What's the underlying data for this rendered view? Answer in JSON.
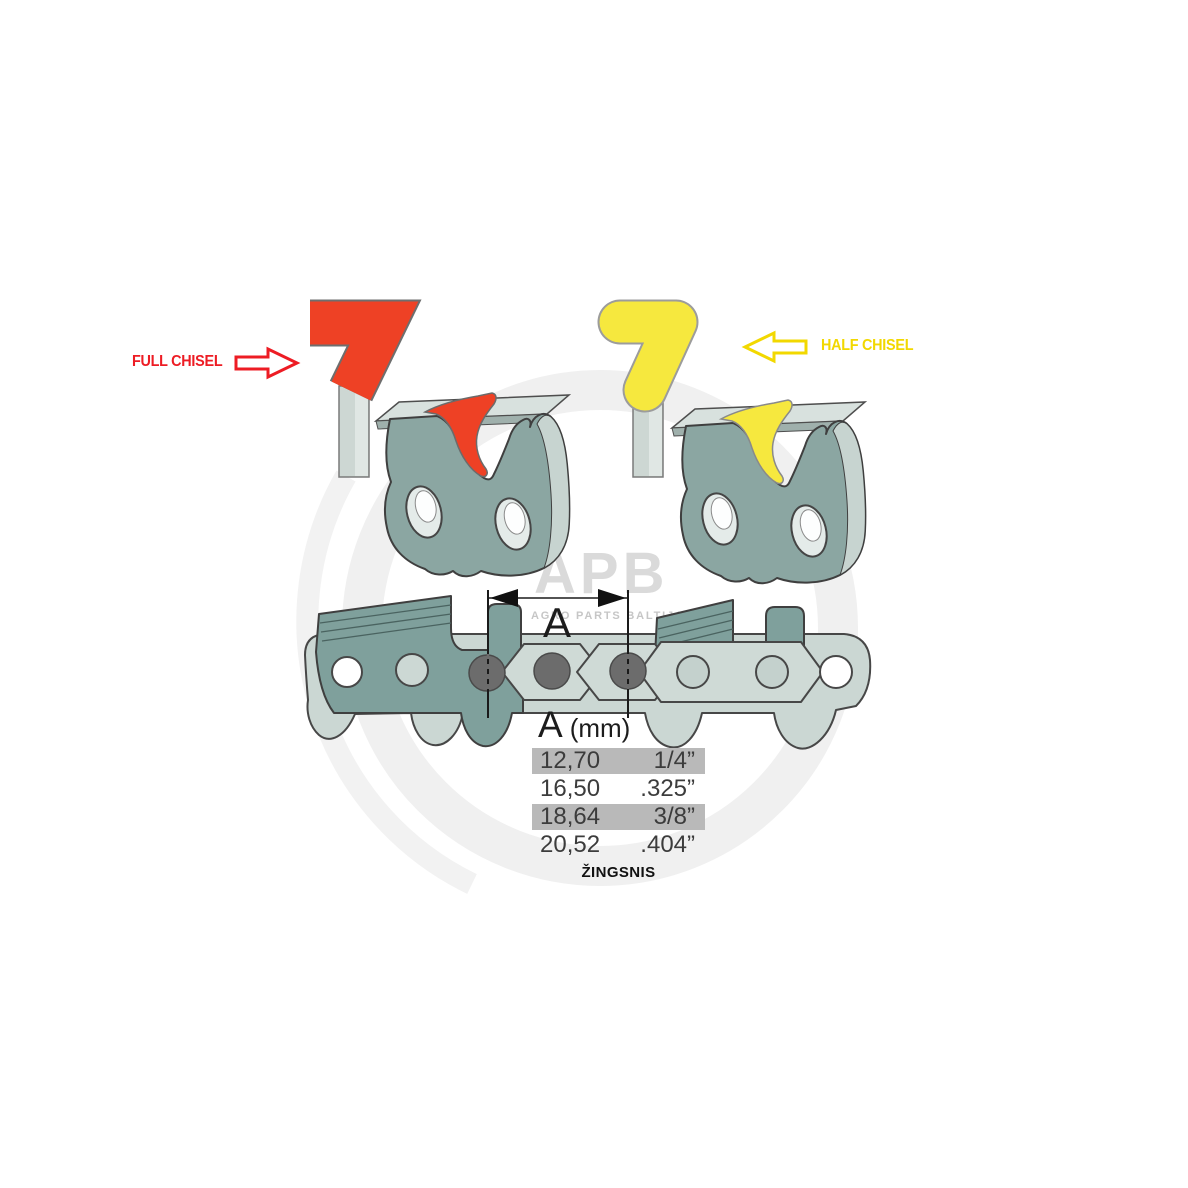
{
  "labels": {
    "full_chisel": "FULL CHISEL",
    "half_chisel": "HALF CHISEL",
    "dimension_letter": "A",
    "pitch_caption": "ŽINGSNIS"
  },
  "watermark": {
    "logo_text": "APB",
    "logo_subtext": "AGRO PARTS BALTIJA"
  },
  "table": {
    "header": {
      "letter": "A",
      "unit": "(mm)"
    },
    "rows": [
      {
        "mm": "12,70",
        "inch": "1/4”",
        "highlighted": true
      },
      {
        "mm": "16,50",
        "inch": ".325”",
        "highlighted": false
      },
      {
        "mm": "18,64",
        "inch": "3/8”",
        "highlighted": true
      },
      {
        "mm": "20,52",
        "inch": ".404”",
        "highlighted": false
      }
    ]
  },
  "colors": {
    "full_chisel_red": "#ee4125",
    "full_chisel_text": "#ed1c24",
    "half_chisel_yellow": "#f6e83e",
    "half_chisel_text": "#f2d800",
    "steel_dark": "#8ba6a2",
    "steel_light": "#cbd7d3",
    "rivet_gray": "#6c6c6c",
    "row_highlight": "#b9b9b9"
  }
}
